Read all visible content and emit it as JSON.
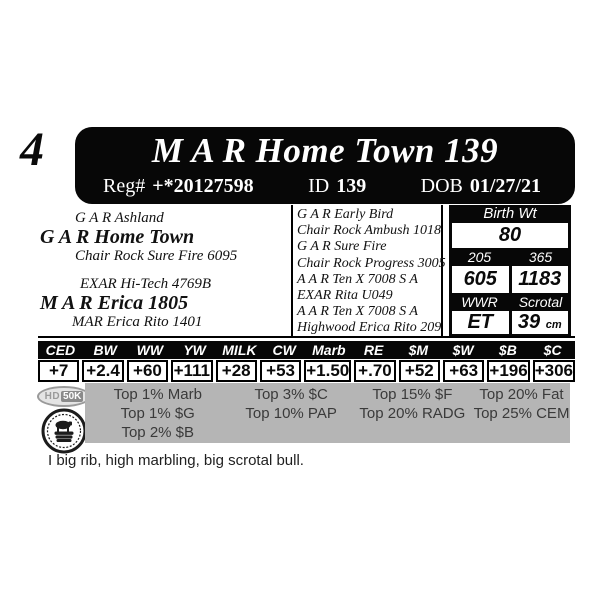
{
  "lot": {
    "number": "4"
  },
  "header": {
    "title": "M A R Home Town 139",
    "reg_label": "Reg#",
    "reg_value": "+*20127598",
    "id_label": "ID",
    "id_value": "139",
    "dob_label": "DOB",
    "dob_value": "01/27/21"
  },
  "pedigree": {
    "sire_group": {
      "sire_of_sire": "G A R Ashland",
      "sire": "G A R Home Town",
      "dam_of_sire": "Chair Rock Sure Fire 6095"
    },
    "dam_group": {
      "sire_of_dam": "EXAR Hi-Tech 4769B",
      "dam": "M A R Erica 1805",
      "dam_of_dam": "MAR Erica Rito 1401"
    },
    "ancestors": [
      "G A R Early Bird",
      "Chair Rock Ambush 1018",
      "G A R Sure Fire",
      "Chair Rock Progress 3005",
      "A A R Ten X 7008 S A",
      "EXAR Rita U049",
      "A A R Ten X 7008 S A",
      "Highwood Erica Rito 209"
    ]
  },
  "stats": {
    "birth_wt_label": "Birth Wt",
    "birth_wt": "80",
    "wt_205_label": "205",
    "wt_365_label": "365",
    "wt_205": "605",
    "wt_365": "1183",
    "wwr_label": "WWR",
    "scrotal_label": "Scrotal",
    "wwr": "ET",
    "scrotal": "39",
    "scrotal_unit": "cm"
  },
  "epd": {
    "columns": [
      "CED",
      "BW",
      "WW",
      "YW",
      "MILK",
      "CW",
      "Marb",
      "RE",
      "$M",
      "$W",
      "$B",
      "$C"
    ],
    "values": [
      "+7",
      "+2.4",
      "+60",
      "+111",
      "+28",
      "+53",
      "+1.50",
      "+.70",
      "+52",
      "+63",
      "+196",
      "+306"
    ]
  },
  "rankings": {
    "columns": [
      [
        "Top 1% Marb",
        "Top 1% $G",
        "Top 2% $B"
      ],
      [
        "Top 3% $C",
        "Top 10% PAP"
      ],
      [
        "Top 15% $F",
        "Top 20% RADG"
      ],
      [
        "Top 20% Fat",
        "Top 25% CEM"
      ]
    ]
  },
  "badges": {
    "hd50k_hd": "HD",
    "hd50k_50k": "50K",
    "seal_icon": "bull-on-bales-seal"
  },
  "note": "I big rib, high marbling, big scrotal bull.",
  "colors": {
    "panel_black": "#070707",
    "rankings_gray": "#b5b5b5",
    "badge_gray": "#9a9a9a"
  }
}
